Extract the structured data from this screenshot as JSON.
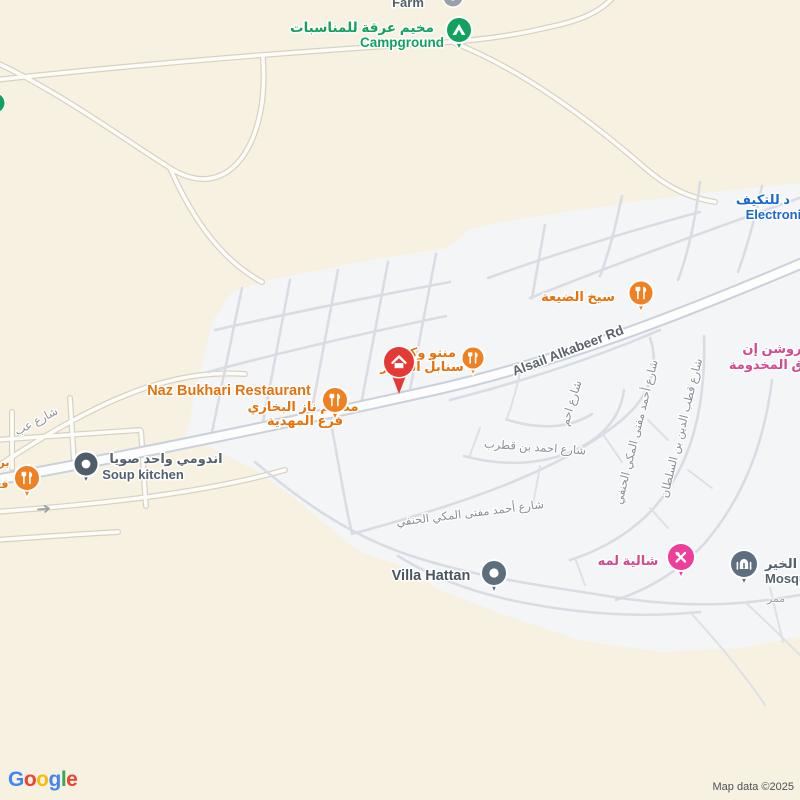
{
  "map": {
    "attribution": "Map data ©2025",
    "logo": {
      "letters": [
        "G",
        "o",
        "o",
        "g",
        "l",
        "e"
      ]
    },
    "pois": {
      "farm": {
        "en": "Farm"
      },
      "campground": {
        "ar": "مخيم عرقة للمناسبات",
        "en": "Campground"
      },
      "electronics": {
        "ar": "د للتكيف",
        "en": "Electronic"
      },
      "seekh": {
        "ar": "سيخ الضيعة"
      },
      "manto": {
        "line1": "منتو وكبش",
        "line2": "سنابل الحجاز"
      },
      "naz": {
        "en": "Naz Bukhari Restaurant",
        "ar1": "مطعم ناز البخاري",
        "ar2": "فرع المهدية"
      },
      "soup": {
        "ar": "اندومي واحد صويا",
        "en": "Soup kitchen"
      },
      "left_fragment": {
        "line1": "بر",
        "line2": "ف"
      },
      "roshan": {
        "line1": "روشن إن",
        "line2": "ق المخدومة"
      },
      "chalet": {
        "ar": "شالية لمه"
      },
      "villa": {
        "en": "Villa Hattan"
      },
      "mosque": {
        "ar": "الخير",
        "en": "Mosqu",
        "passage": "ممر"
      }
    },
    "roads": {
      "main": "Alsail Alkabeer Rd",
      "street_left": "شارع عب",
      "qutrub": "شارع احمد بن قطرب",
      "mufti": "شارع أحمد مفتى المكي الحنفي",
      "sultan": "شارع قطب الدين بن السلطان",
      "ahm_fragment": "شارع احم"
    },
    "icons": {
      "campground": "tent-triangle",
      "restaurant": "fork-knife",
      "selected_place": "house",
      "soup_kitchen": "dot",
      "villa": "dot",
      "mosque": "mosque-dome",
      "chalet": "crossed-tools",
      "one_way": "arrow-right"
    },
    "colors": {
      "background": "#f6f1e1",
      "builtup_area": "#f4f5f7",
      "main_road_casing": "#c9d1da",
      "main_road_fill": "#fdfdfd",
      "minor_street": "#d9dde3",
      "poi_orange": "#e8710a",
      "marker_orange": "#f08021",
      "poi_green": "#12a15f",
      "poi_blue": "#1967d2",
      "poi_pink_text": "#d4488f",
      "marker_pink": "#ee3e9a",
      "poi_slate_text": "#54616b",
      "marker_slate": "#5d6f7d",
      "marker_red": "#e53935",
      "street_label": "#8a9097",
      "road_label": "#5c636b",
      "attribution_text": "#4d5156"
    }
  }
}
